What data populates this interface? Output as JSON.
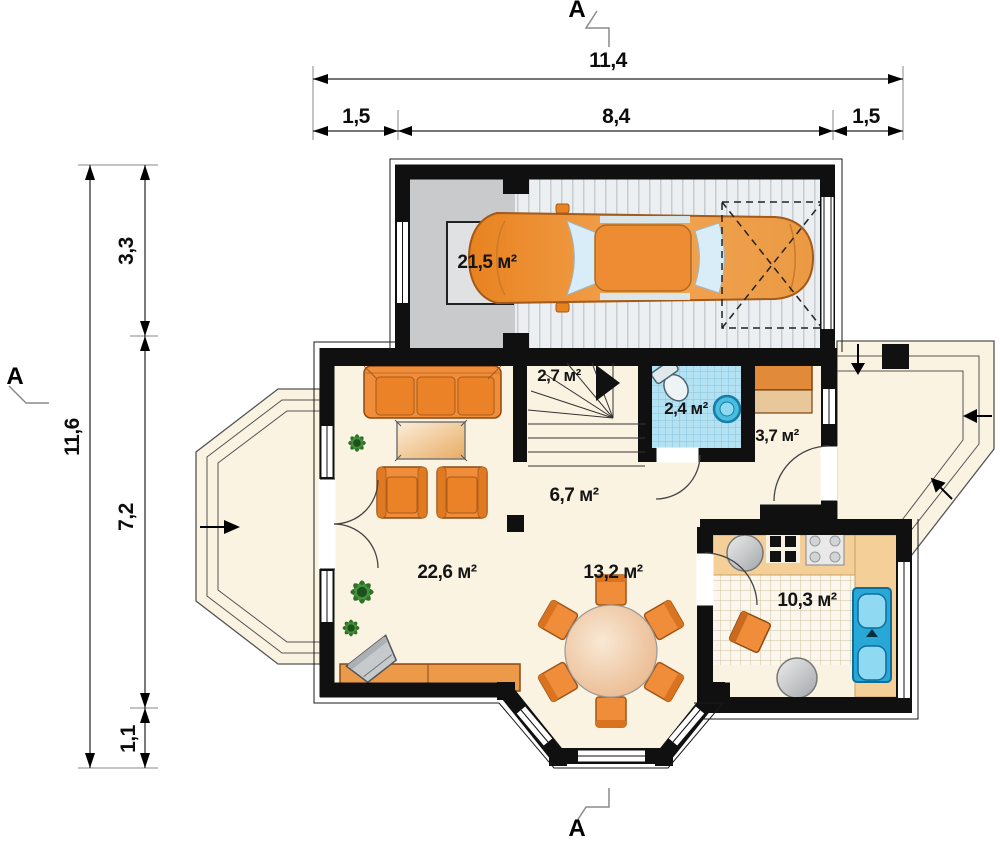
{
  "plan": {
    "section_markers": {
      "top": "А",
      "bottom": "А",
      "left": "А"
    },
    "dimensions_top": {
      "total": "11,4",
      "segments": [
        "1,5",
        "8,4",
        "1,5"
      ]
    },
    "dimensions_left": {
      "total": "11,6",
      "segments": [
        "3,3",
        "7,2",
        "1,1"
      ]
    },
    "rooms": {
      "garage": "21,5 м²",
      "stairs": "2,7 м²",
      "bathroom": "2,4 м²",
      "entry_hall": "3,7 м²",
      "hall": "6,7 м²",
      "living_room": "22,6 м²",
      "dining": "13,2 м²",
      "kitchen": "10,3 м²"
    },
    "colors": {
      "wall": "#111111",
      "floor": "#faf3e2",
      "furniture_orange": "#ee8c3a",
      "bathroom_tile": "#b5e2f2",
      "sink_blue": "#2bb1e0",
      "kitchen_counter": "#f4cf98",
      "garage_floor": "#eceff1",
      "storage_gray": "#c9cacc"
    }
  }
}
